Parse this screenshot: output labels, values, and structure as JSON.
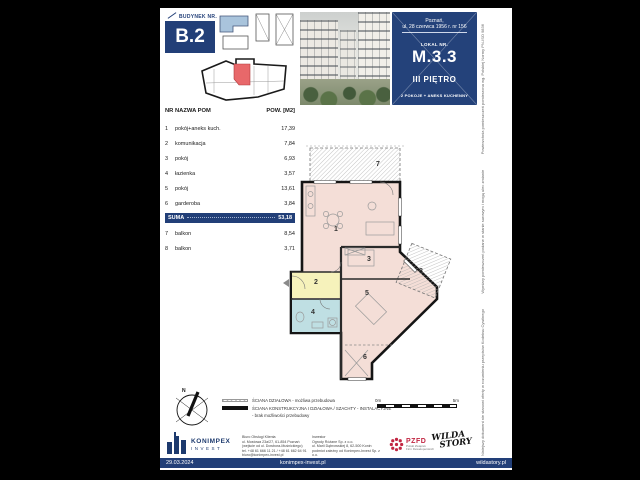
{
  "colors": {
    "brand_blue": "#223f78",
    "unit_red": "#e8686a",
    "site_blue": "#a9c4dc",
    "room_pink": "#f4ded7",
    "hall_yellow": "#f6f2bb",
    "bath_teal": "#bfdfe3",
    "pzfd_red": "#c22642"
  },
  "header": {
    "building_label": "BUDYNEK NR.",
    "building_no": "B.2",
    "address_line1": "Poznań,",
    "address_line2": "ul. 28 czerwca 1956 r. nr 156",
    "unit_label": "LOKAL NR.",
    "unit_no": "M.3.3",
    "floor": "III PIĘTRO",
    "rooms_line": "2 POKOJE  +  ANEKS KUCHENNY"
  },
  "table": {
    "col_nr": "NR",
    "col_name": "NAZWA POM",
    "col_area": "POW. [M2]",
    "rows": [
      {
        "nr": "1",
        "name": "pokój+aneks kuch.",
        "area": "17,39"
      },
      {
        "nr": "2",
        "name": "komunikacja",
        "area": "7,84"
      },
      {
        "nr": "3",
        "name": "pokój",
        "area": "6,93"
      },
      {
        "nr": "4",
        "name": "łazienka",
        "area": "3,57"
      },
      {
        "nr": "5",
        "name": "pokój",
        "area": "13,61"
      },
      {
        "nr": "6",
        "name": "garderoba",
        "area": "3,84"
      }
    ],
    "suma": {
      "label": "SUMA",
      "value": "53,18"
    },
    "balcony_rows": [
      {
        "nr": "7",
        "name": "balkon",
        "area": "8,54"
      },
      {
        "nr": "8",
        "name": "balkon",
        "area": "3,71"
      }
    ]
  },
  "plan": {
    "rooms": {
      "r1": "1",
      "r2": "2",
      "r3": "3",
      "r4": "4",
      "r5": "5",
      "r6": "6",
      "r7": "7",
      "r8": "8"
    },
    "north": "N"
  },
  "legend": {
    "item1": "ŚCIANA DZIAŁOWA - możliwa przebudowa",
    "item2": "ŚCIANA KONSTRUKCYJNA I DZIAŁOWA / SZACHTY - INSTALACYJNE",
    "item2b": "- brak możliwości przebudowy"
  },
  "scalebar": {
    "left": "0m",
    "right": "5m"
  },
  "disclaimer": {
    "legal": "Niniejszy dokument nie stanowi oferty w rozumieniu przepisów Kodeksu Cywilnego",
    "dims": "Wymiary pomieszczeń podane w stanie surowym i mogą ulec zmianie",
    "norm": "Powierzchnia pomieszczeń pomierzona wg. Polskiej Normy PN-ISO 9836"
  },
  "footer": {
    "konimpex_name": "KONIMPEX",
    "konimpex_sub": "INVEST",
    "office": {
      "l0": "Biuro Obsługi Klienta",
      "l1": "ul. Mostowa 23a/27, 61-854 Poznań",
      "l2": "(wejście od ul. Dowbora-Muśnickiego)",
      "l3": "tel. +48 61 666 11 21 / +48 61 662 64 91",
      "l4": "biuro@konimpex-invest.pl"
    },
    "investor": {
      "l0": "Inwestor",
      "l1": "Ogrody Różane Sp. z o.o.",
      "l2": "ul. Marii Dąbrowskiej 8, 62-500 Konin",
      "l3": "podmiot zależny od Konimpex-Invest Sp. z o.o."
    },
    "pzfd_acronym": "PZFD",
    "pzfd_line1": "Polski Związek",
    "pzfd_line2": "Firm Deweloperskich",
    "wilda_line1": "WILDA",
    "wilda_line2": "STORY"
  },
  "bottom_bar": {
    "date": "29.03.2024",
    "url_center": "konimpex-invest.pl",
    "url_right": "wildastory.pl"
  }
}
